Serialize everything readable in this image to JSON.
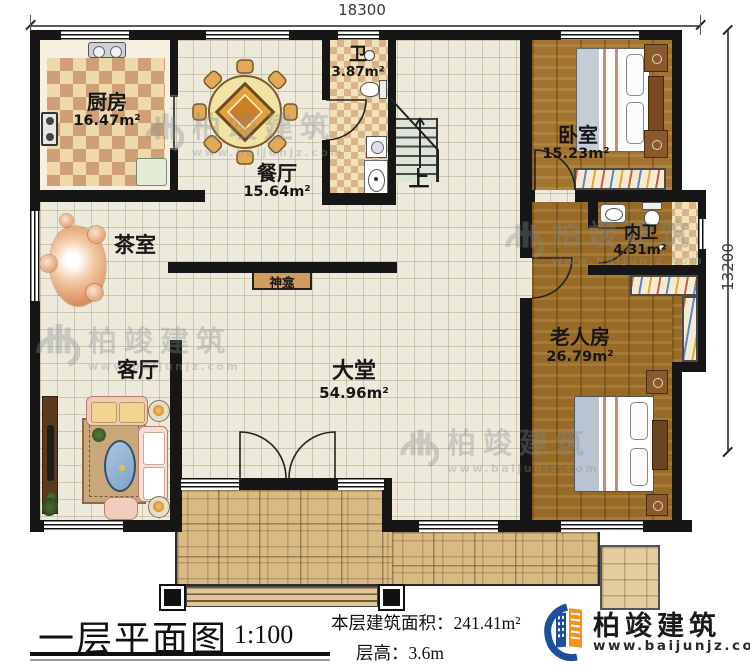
{
  "dimensions": {
    "width": "18300",
    "height": "13200"
  },
  "rooms": {
    "kitchen": {
      "name": "厨房",
      "area": "16.47m²"
    },
    "dining": {
      "name": "餐厅",
      "area": "15.64m²"
    },
    "bath": {
      "name": "卫",
      "area": "3.87m²"
    },
    "bedroom": {
      "name": "卧室",
      "area": "15.23m²"
    },
    "tea": {
      "name": "茶室"
    },
    "ensuite": {
      "name": "内卫",
      "area": "4.31m²"
    },
    "living": {
      "name": "客厅"
    },
    "hall": {
      "name": "大堂",
      "area": "54.96m²"
    },
    "elder": {
      "name": "老人房",
      "area": "26.79m²"
    },
    "shrine": {
      "name": "神龛"
    },
    "stairs": {
      "up": "上"
    }
  },
  "footer": {
    "plan_title": "一层平面图",
    "scale": "1:100",
    "area_label": "本层建筑面积：",
    "area_value": "241.41m²",
    "height_label": "层高：",
    "height_value": "3.6m"
  },
  "branding": {
    "company": "柏竣建筑",
    "website": "www.baijunjz.com"
  },
  "watermark": {
    "text": "柏竣建筑",
    "url": "www.baijunjz.com"
  },
  "colors": {
    "logo_blue": "#1d4f9b",
    "logo_orange": "#f6921e",
    "wall": "#161616"
  }
}
